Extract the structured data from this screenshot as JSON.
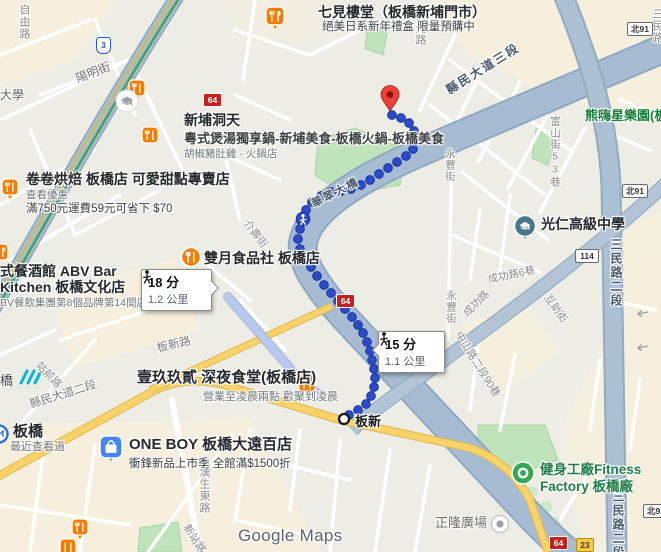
{
  "map": {
    "watermark": "Google Maps",
    "colors": {
      "route_blue": "#2b4bc8",
      "alt_route": "#b7c9ef",
      "road_major": "#a7bcd2",
      "road_yellow": "#f7d36a",
      "park_green": "#bfe3ba",
      "shield_red": "#c5221f",
      "poi_orange": "#f57c00",
      "poi_blue": "#4285f4",
      "poi_green": "#34a853",
      "destination_red": "#ea4335",
      "promo_green_text": "#188038"
    },
    "route": {
      "origin_stop": "板新",
      "bubble_18": {
        "duration": "18 分",
        "distance": "1.2 公里"
      },
      "bubble_15": {
        "duration": "15 分",
        "distance": "1.1 公里"
      }
    },
    "shields": {
      "s3": "3",
      "s64": "64",
      "n91": "北91",
      "n92": "北92",
      "s114": "114",
      "s23": "23"
    },
    "roads": {
      "ziyou": "自由路",
      "yangming": "陽明街",
      "juguang": "莒光路",
      "xianmin_3": "縣民大道三段",
      "huacui_bridge": "華翠大橋",
      "jieshou": "介壽街",
      "yongfeng_a": "永豐街",
      "yongfeng_b": "永豐街",
      "qiaoren_10": "僑仁街10巷",
      "fushan_53": "富山街53巷",
      "sanmin": "三民路",
      "sanmin_2": "三民路二段",
      "chenggong_6": "成功路6巷",
      "chenggong": "成功路",
      "huzhu": "互助街",
      "zhongshan_90": "中山路二段90巷",
      "banxin_road": "板新路",
      "xianmin_2": "縣民大道二段",
      "zhanqian": "站前路",
      "hansheng": "漢生東路",
      "xinzhan": "新站路"
    },
    "pois": {
      "qijianloutang": {
        "name": "七見樓堂（板橋新埔門市）",
        "promo": "絕美日系新年禮盒 限量預購中"
      },
      "daxue": "大學",
      "xinpu_dongtian": {
        "name": "新埔洞天",
        "name2": "粵式煲湯獨享鍋-新埔美食-板橋火鍋-板橋美食",
        "sub": "胡椒豬肚雞 - 火鍋店"
      },
      "juanjuan": {
        "name": "卷卷烘焙 板橋店 可愛甜點專賣店",
        "link": "查看優惠",
        "promo": "滿750元運費59元可省下 $70"
      },
      "abv": {
        "name": "式餐酒館 ABV Bar",
        "name2": "Kitchen 板橋文化店",
        "sub": "BV餐飲集團第8個品牌第14間店"
      },
      "shuangyue": {
        "name": "雙月食品社 板橋店"
      },
      "yijiujiuer": {
        "name": "壹玖玖貳 深夜食堂(板橋店)",
        "sub": "營業至凌晨兩點 歡聚到凌晨"
      },
      "banqiao_station": {
        "name": "板橋",
        "sub": "最近查看過"
      },
      "qiao": "橋",
      "oneboy": {
        "name": "ONE BOY 板橋大遠百店",
        "promo": "衝鋒新品上市季 全館滿$1500折"
      },
      "guangren": {
        "name": "光仁高級中學"
      },
      "fitness": {
        "name": "健身工廠Fitness",
        "name2": "Factory 板橋廠"
      },
      "zhenglong": {
        "name": "正隆廣場"
      },
      "xionghai": {
        "name": "熊嗨星樂園(板橋店)"
      }
    }
  }
}
